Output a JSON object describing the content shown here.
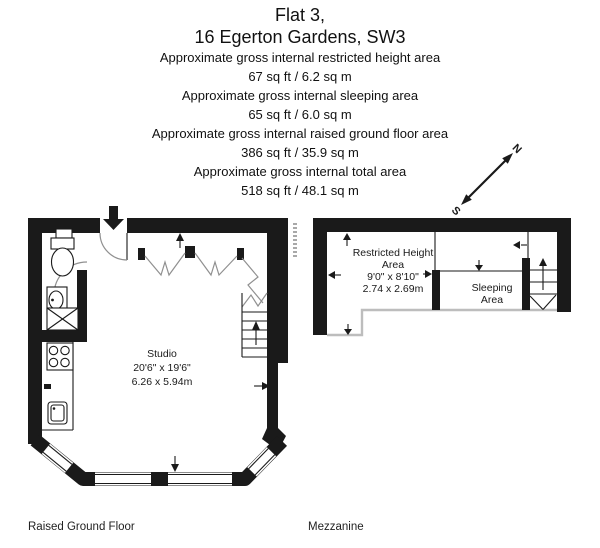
{
  "header": {
    "title_line1": "Flat 3,",
    "title_line2": "16 Egerton Gardens, SW3",
    "area_lines": [
      "Approximate gross internal restricted height area",
      "67 sq ft  / 6.2 sq m",
      "Approximate gross internal sleeping area",
      "65 sq ft  / 6.0 sq m",
      "Approximate gross internal raised ground floor area",
      "386 sq ft  / 35.9 sq m",
      "Approximate gross internal total area",
      "518 sq ft  / 48.1 sq m"
    ]
  },
  "compass": {
    "north_label": "N",
    "south_label": "S"
  },
  "floors": {
    "raised_ground": {
      "name": "Raised Ground Floor",
      "room": {
        "name": "Studio",
        "dims_imperial": "20'6\" x 19'6\"",
        "dims_metric": "6.26 x 5.94m"
      }
    },
    "mezzanine": {
      "name": "Mezzanine",
      "restricted": {
        "line1": "Restricted Height",
        "line2": "Area",
        "dims_imperial": "9'0\" x 8'10\"",
        "dims_metric": "2.74 x 2.69m"
      },
      "sleeping": {
        "line1": "Sleeping",
        "line2": "Area"
      }
    }
  },
  "colors": {
    "wall": "#1a1a1a",
    "door_line": "#909090",
    "boundary": "#bdbdbd"
  }
}
